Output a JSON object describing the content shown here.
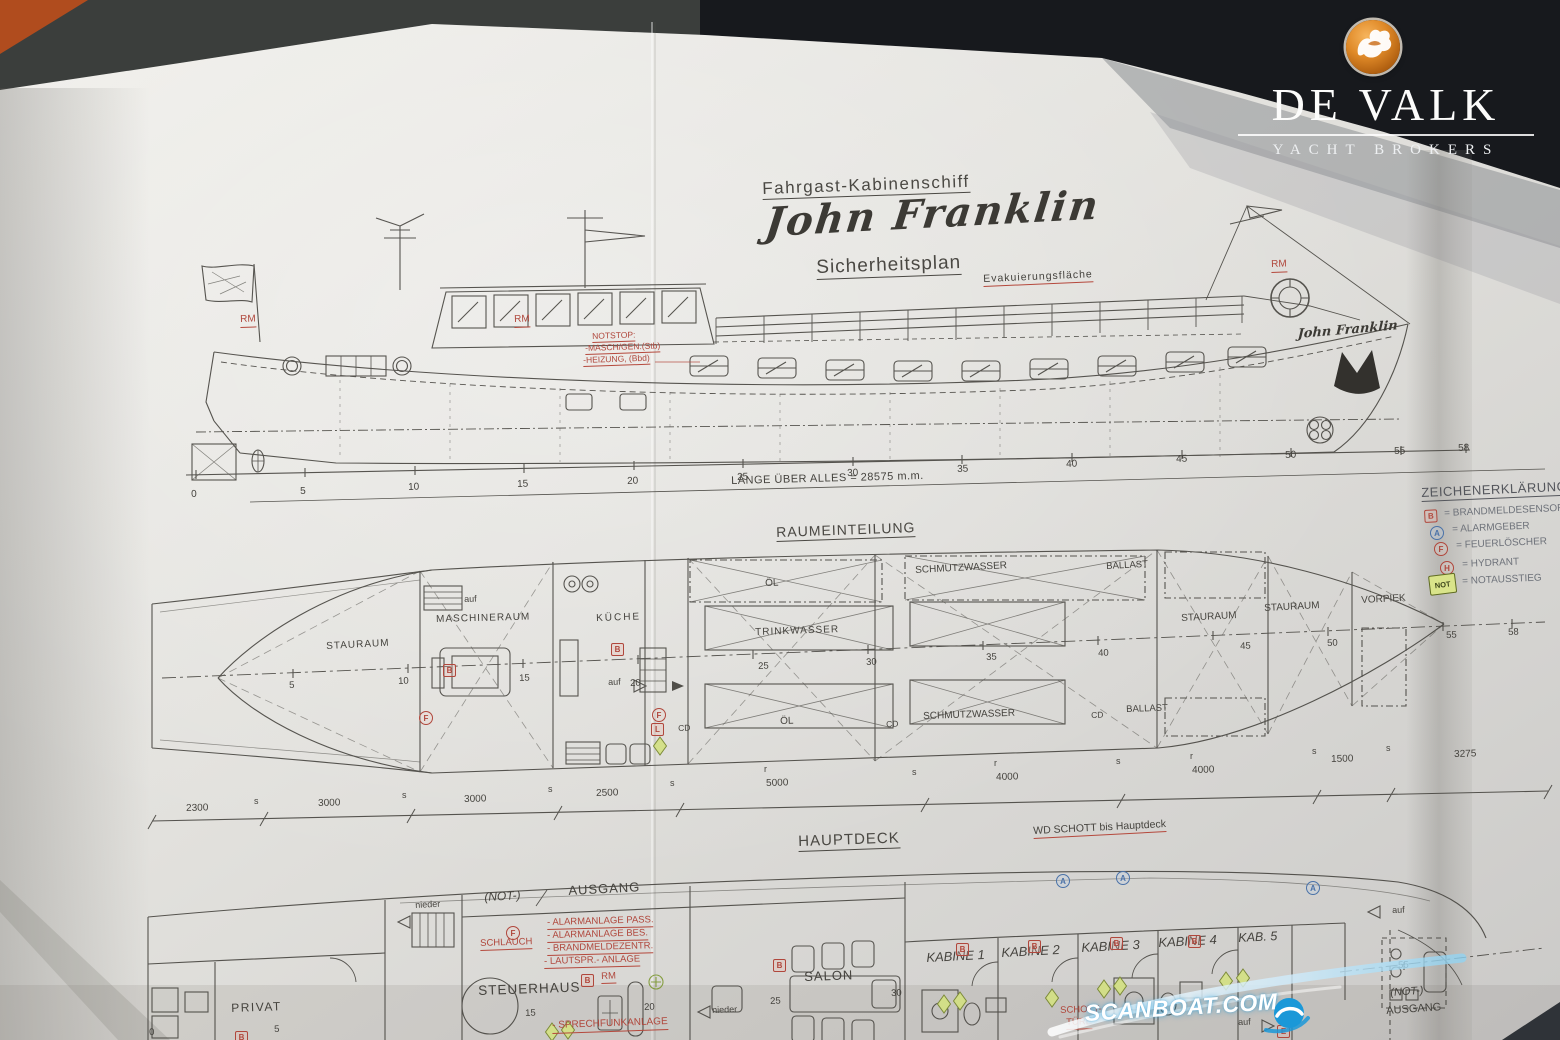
{
  "brand": {
    "name": "DE VALK",
    "tagline": "YACHT BROKERS",
    "badge_color": "#e08a28",
    "badge_icon": "falcon-icon"
  },
  "watermark": {
    "text": "SCANBOAT.COM",
    "accent_color": "#1b98d8"
  },
  "titles": {
    "type": "Fahrgast-Kabinenschiff",
    "name": "John Franklin",
    "plan": "Sicherheitsplan"
  },
  "symbols": {
    "b": "B",
    "a": "A",
    "f": "F",
    "h": "H",
    "l": "L",
    "e": "E",
    "not": "NOT",
    "rm": "RM",
    "cd": "CD",
    "s": "s",
    "r": "r",
    "auf": "auf",
    "nieder": "nieder"
  },
  "side_view": {
    "notstop": [
      "NOTSTOP:",
      "-MASCH/GEN.(Stb)",
      "-HEIZUNG, (Bbd)"
    ],
    "evacuation_area": "Evakuierungsfläche",
    "bow_name": "John Franklin",
    "scale": [
      "0",
      "5",
      "10",
      "15",
      "20",
      "25",
      "30",
      "35",
      "40",
      "45",
      "50",
      "55",
      "58"
    ],
    "length_note": "LÄNGE ÜBER ALLES = 28575 m.m."
  },
  "legend": {
    "title": "ZEICHENERKLÄRUNG",
    "items": [
      {
        "symbol": "B",
        "label": "= BRANDMELDESENSOR"
      },
      {
        "symbol": "A",
        "label": "= ALARMGEBER"
      },
      {
        "symbol": "F",
        "label": "= FEUERLÖSCHER"
      },
      {
        "symbol": "H",
        "label": "= HYDRANT"
      },
      {
        "symbol": "NOT",
        "label": "= NOTAUSSTIEG"
      }
    ]
  },
  "tank_plan": {
    "title": "RAUMEINTEILUNG",
    "rooms": {
      "stauraum_aft": "STAURAUM",
      "maschineraum": "MASCHINERAUM",
      "kueche": "KÜCHE",
      "oel_top": "ÖL",
      "schmutzwasser_top": "SCHMUTZWASSER",
      "ballast_top": "BALLAST",
      "trinkwasser": "TRINKWASSER",
      "oel_bottom": "ÖL",
      "schmutzwasser_bottom": "SCHMUTZWASSER",
      "ballast_bottom": "BALLAST",
      "stauraum_mid": "STAURAUM",
      "stauraum_fwd": "STAURAUM",
      "vorpiek": "VORPIEK"
    },
    "scale": [
      "5",
      "10",
      "15",
      "20",
      "25",
      "30",
      "35",
      "40",
      "45",
      "50",
      "55",
      "58"
    ],
    "dimensions": [
      "2300",
      "3000",
      "3000",
      "2500",
      "5000",
      "4000",
      "4000",
      "1500",
      "3275"
    ]
  },
  "main_deck": {
    "title": "HAUPTDECK",
    "wd_note": "WD SCHOTT bis Hauptdeck",
    "not_exit": "(NOT-)",
    "ausgang": "AUSGANG",
    "schlauch": "SCHLAUCH",
    "alarm_notes": [
      "- ALARMANLAGE PASS.",
      "- ALARMANLAGE BES.",
      "- BRANDMELDEZENTR.",
      "- LAUTSPR.- ANLAGE"
    ],
    "sprechfunk": "- SPRECHFUNKANLAGE",
    "rooms": {
      "steuerhaus": "STEUERHAUS",
      "salon": "SALON",
      "privat": "PRIVAT",
      "kabine1": "KABINE 1",
      "kabine2": "KABINE 2",
      "kabine3": "KABINE 3",
      "kabine4": "KABINE 4",
      "kab5": "KAB. 5"
    },
    "schott_tuer": [
      "SCHOTT-",
      "TÜRE"
    ],
    "not_exit2": "(NOT-)",
    "ausgang2": "AUSGANG",
    "numbers": {
      "n0": "0",
      "n5": "5",
      "n15": "15",
      "n20": "20",
      "n25": "25",
      "n30": "30",
      "n55": "55"
    }
  }
}
